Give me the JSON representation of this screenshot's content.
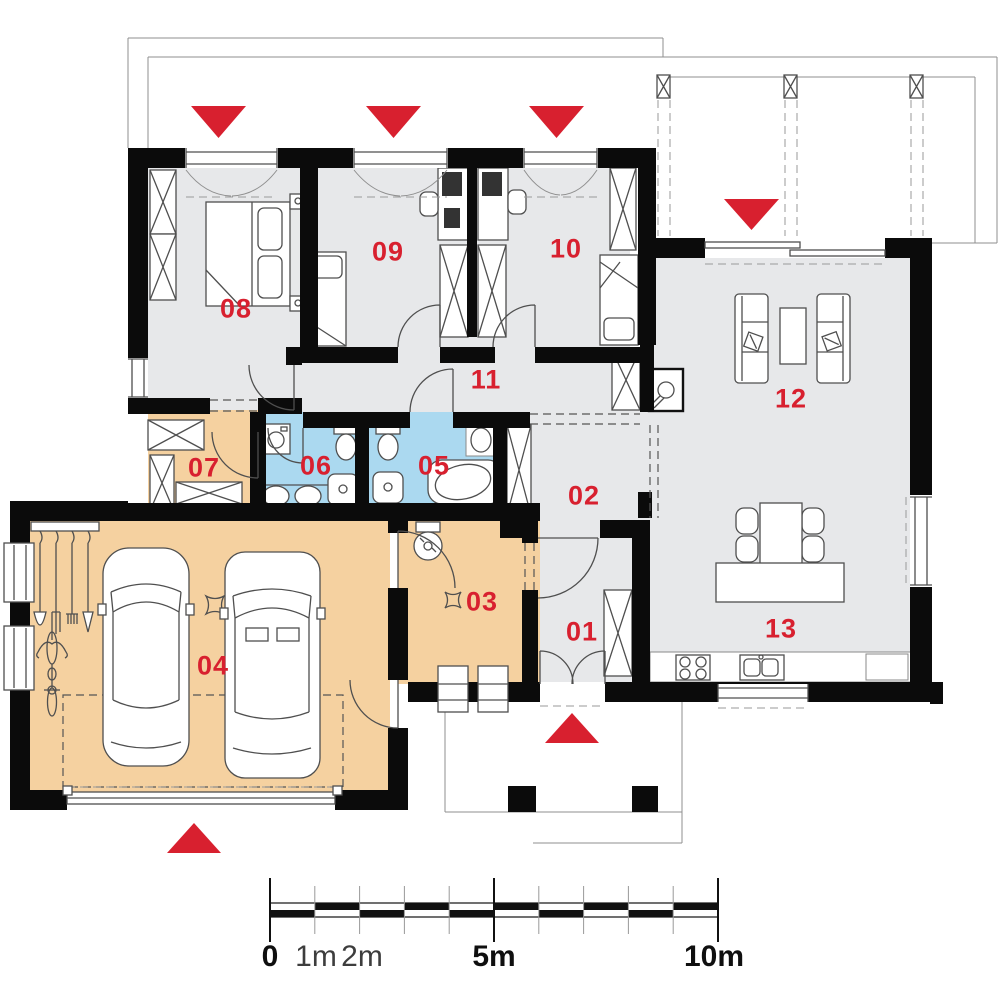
{
  "colors": {
    "accent": "#d8202f",
    "wall": "#0b0b0b",
    "floor_gray": "#e7e8ea",
    "floor_orange": "#f5d1a0",
    "floor_blue": "#abd9f0"
  },
  "rooms": [
    {
      "label": "01"
    },
    {
      "label": "02"
    },
    {
      "label": "03"
    },
    {
      "label": "04"
    },
    {
      "label": "05"
    },
    {
      "label": "06"
    },
    {
      "label": "07"
    },
    {
      "label": "08"
    },
    {
      "label": "09"
    },
    {
      "label": "10"
    },
    {
      "label": "11"
    },
    {
      "label": "12"
    },
    {
      "label": "13"
    }
  ],
  "scalebar": {
    "labels": [
      "0",
      "1m",
      "2m",
      "5m",
      "10m"
    ]
  }
}
